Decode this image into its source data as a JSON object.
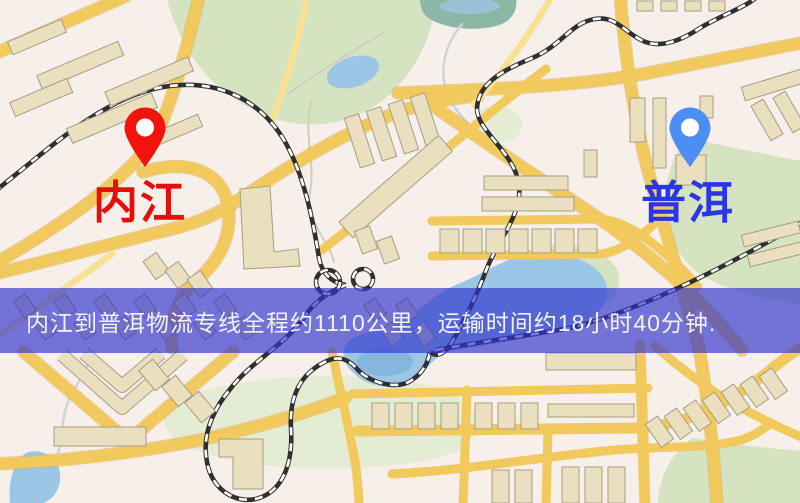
{
  "map": {
    "origin_marker": {
      "label": "内江",
      "pin_icon": "red-location-pin",
      "pin_color": "#f2140c",
      "label_color": "#e60e0a"
    },
    "destination_marker": {
      "label": "普洱",
      "pin_icon": "blue-location-pin",
      "pin_color": "#4d8ef2",
      "label_color": "#2836e6"
    },
    "info_banner": {
      "text": "内江到普洱物流专线全程约1110公里，运输时间约18小时40分钟.",
      "distance_text": "约1110公里",
      "duration_text": "约18小时40分钟",
      "background_color": "rgba(47,50,205,0.66)",
      "text_color": "#f2f2f2"
    },
    "palette": {
      "background": "#f7efe9",
      "park": "#d6e3c1",
      "park_pale": "#e4edd3",
      "water": "#9cc6e6",
      "water_teal": "#8ab7a6",
      "stream": "#ccd4da",
      "road_major": "#f2c95c",
      "road_casing": "#e2ae4c",
      "road_minor": "#f8e193",
      "building_fill": "#eae0bf",
      "building_stroke": "#a69d83",
      "railway": "#2f2f2f"
    }
  }
}
